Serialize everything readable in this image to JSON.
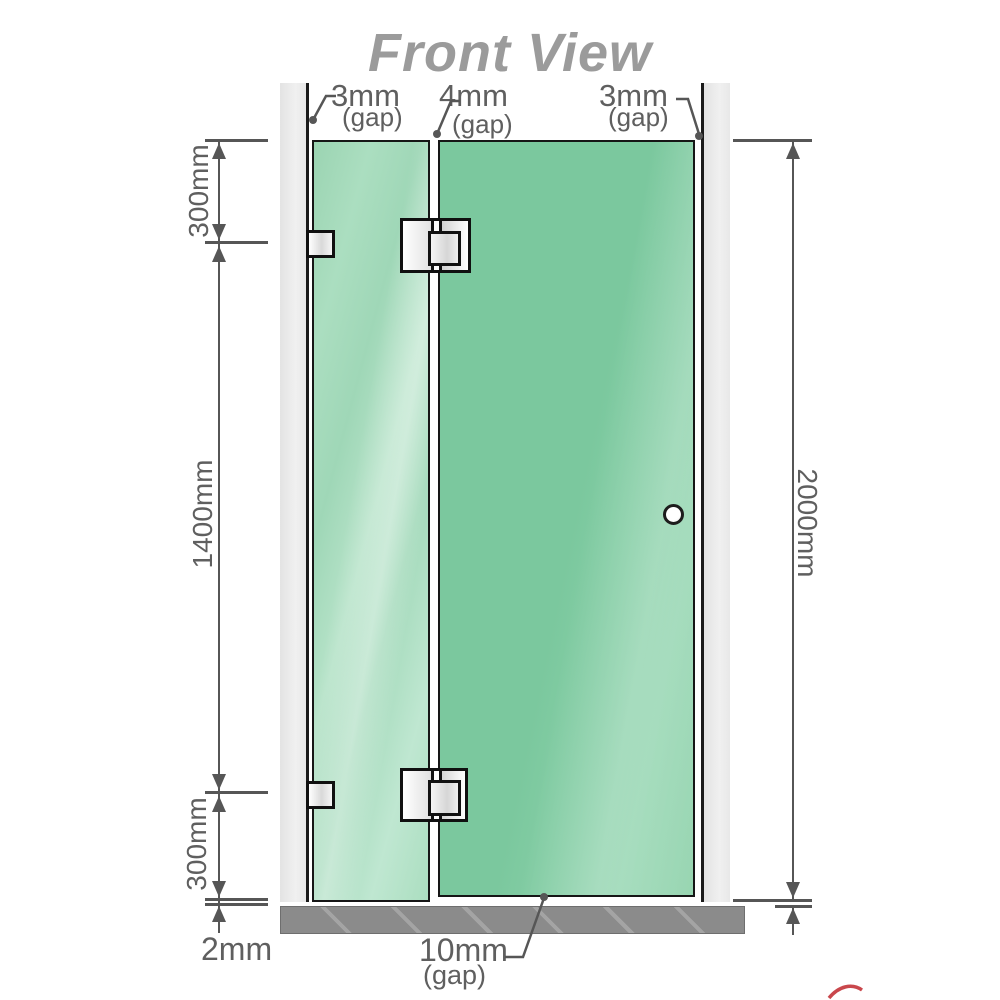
{
  "title": "Front View",
  "gaps": {
    "left": {
      "value": "3mm",
      "label": "(gap)"
    },
    "middle": {
      "value": "4mm",
      "label": "(gap)"
    },
    "right": {
      "value": "3mm",
      "label": "(gap)"
    },
    "bottom": {
      "value": "10mm",
      "label": "(gap)"
    }
  },
  "heights": {
    "top_section": "300mm",
    "middle_section": "1400mm",
    "bottom_section": "300mm",
    "total": "2000mm"
  },
  "floor": {
    "thickness": "2mm"
  },
  "colors": {
    "glass_door": "#7bc89e",
    "glass_fixed_panel": "#a6dabe",
    "wall": "#eaeaea",
    "floor_base": "#8b8b8b",
    "dimension_lines": "#565656",
    "label_text": "#5f5f5f",
    "title_text": "#9b9b9b",
    "accent_red": "#c0272d"
  }
}
